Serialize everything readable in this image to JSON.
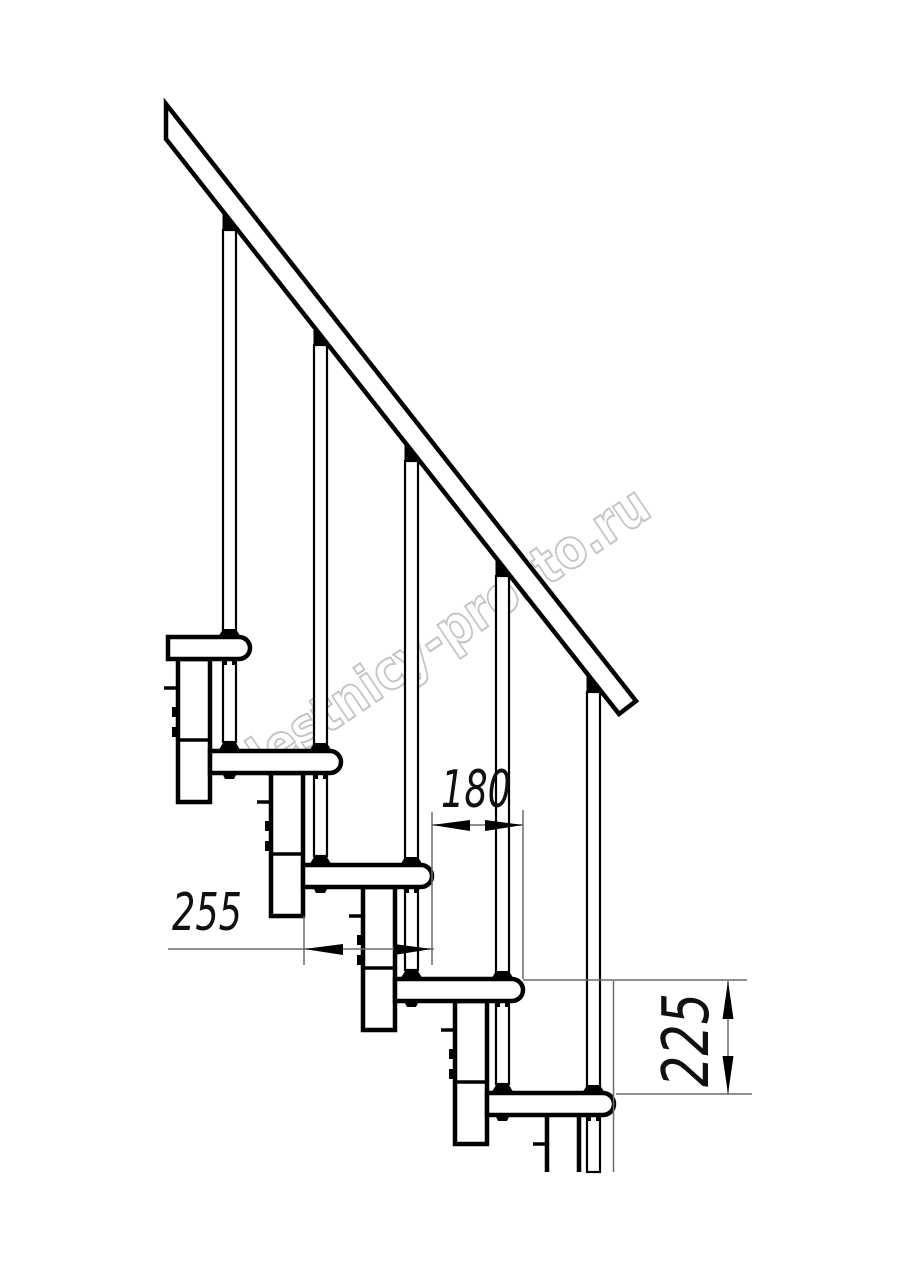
{
  "drawing": {
    "title": "modular staircase side elevation",
    "watermark": {
      "text": "lestnicy-prosto.ru",
      "color": "#c5c5c5"
    },
    "dimensions": {
      "tread_depth": {
        "value": "255"
      },
      "step_run": {
        "value": "180"
      },
      "step_rise": {
        "value": "225"
      }
    },
    "colors": {
      "line": "#000000",
      "thin_line": "#6b6b6b",
      "background": "#ffffff"
    },
    "counts": {
      "treads": 5,
      "balusters": 5,
      "support_modules": 5,
      "handrails": 1
    }
  }
}
